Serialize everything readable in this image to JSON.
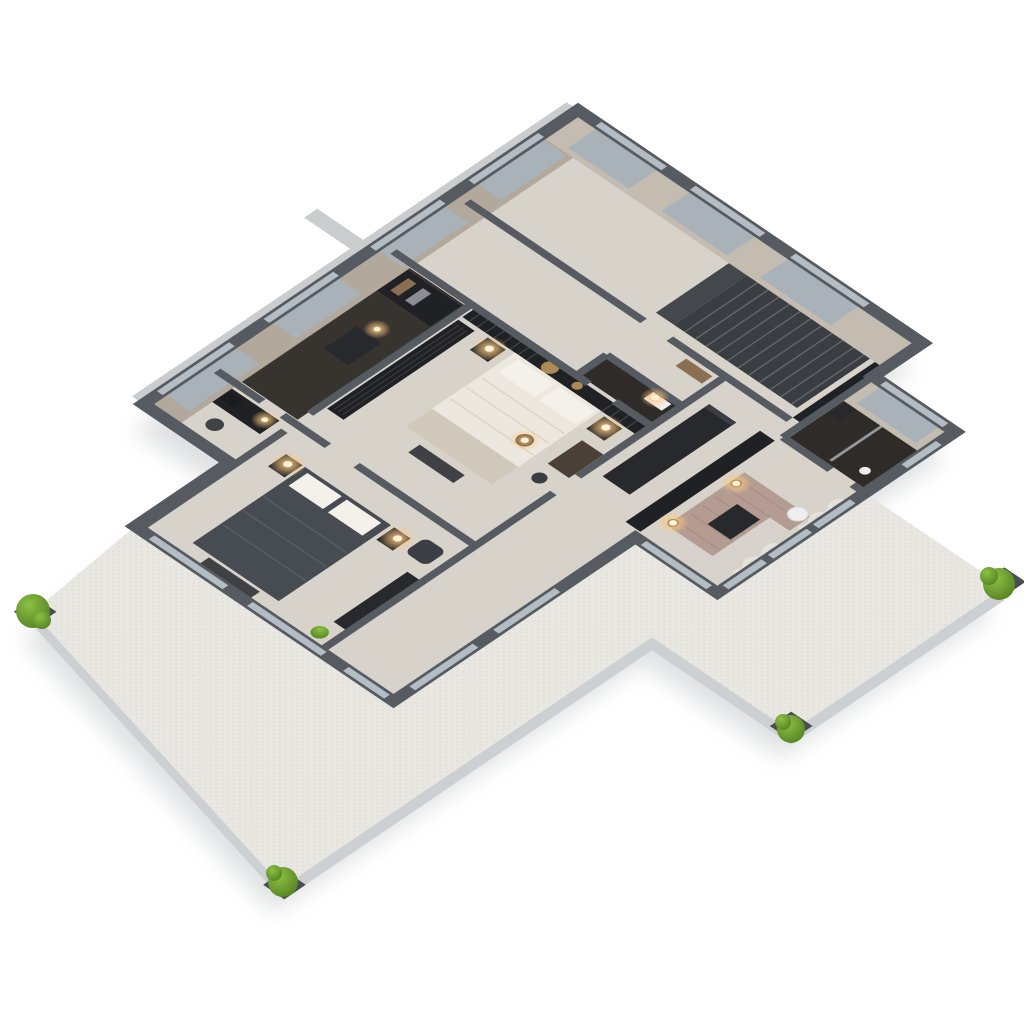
{
  "scene": {
    "kind": "3d-floor-plan-render",
    "title": "Apartment 3D floor plan (axonometric render)",
    "view": "top-down axonometric, plan rotated ~34 degrees, white studio background",
    "building_shape": "L-shaped apartment with wrap-around L-shaped terrace at south and east",
    "text_visible_in_image": "none"
  },
  "colors": {
    "bg": "#ffffff",
    "shadow": "#9a9da1",
    "slab_side": "#cdd0d3",
    "terrace": "#e9e7e1",
    "terrace_speckle": "#dcd9d2",
    "wall": "#565b62",
    "wallface": "#c4bcb1",
    "wallface_w": "#b2a99c",
    "glass": "#b5bdc4",
    "glass_pane": "#a9b2b8",
    "floor": "#d8d3ca",
    "floor_dark": "#37332f",
    "floor_bath": "#2e2b29",
    "furn_dark": "#27292d",
    "furn_darker": "#1f2124",
    "bed_cream": "#ece7df",
    "bed_fold": "#d6cfc2",
    "pillow": "#f4f1ea",
    "sofa": "#d7d3cc",
    "rug": "#b49c92",
    "rug_dark": "#9c8177",
    "duvet_dark": "#474b52",
    "duvet_fold": "#5c6066",
    "bench": "#3f4145",
    "wood": "#8a6f52",
    "gold": "#ad8a55",
    "glow": "#ffc87d",
    "glow_core": "#fff1d8",
    "tree_light": "#8cc044",
    "tree_dark": "#4e7a1e",
    "planter": "#4a4d52",
    "curtain": "#e7e3da",
    "fin": "#caccce",
    "stair": "#3a3d42",
    "stair_light": "#63676d",
    "landing": "#44474c",
    "slat": "#44474d",
    "fixture_white": "#eceeef"
  },
  "rooms": [
    {
      "id": "entry-hall",
      "label": "Entry hall with staircase",
      "furniture": [
        "staircase",
        "potted-plant"
      ]
    },
    {
      "id": "corridor",
      "label": "Central corridor",
      "furniture": [
        "console-table"
      ]
    },
    {
      "id": "bathroom-small",
      "label": "Small bathroom (dark tile)",
      "furniture": [
        "vanity"
      ]
    },
    {
      "id": "bathroom-wing",
      "label": "Wing bathroom (dark tile)",
      "furniture": [
        "shower-glass",
        "wc",
        "vanity"
      ]
    },
    {
      "id": "kitchen",
      "label": "Kitchen",
      "furniture": [
        "island",
        "tall-cabinets"
      ]
    },
    {
      "id": "living-room",
      "label": "Living room",
      "furniture": [
        "media-wall",
        "rug",
        "sofa",
        "coffee-table",
        "floor-lamp",
        "floor-lamp",
        "round-side-table",
        "curtains"
      ]
    },
    {
      "id": "master-bedroom",
      "label": "Master bedroom",
      "furniture": [
        "slatted-headboard-wall",
        "gold-wall-discs",
        "double-bed-cream",
        "nightstand",
        "nightstand",
        "wardrobe-glass",
        "bench",
        "pendant-lamp",
        "desk",
        "chair"
      ]
    },
    {
      "id": "walk-in-closet",
      "label": "Walk-in closet (dark floor)",
      "furniture": [
        "wardrobe-units",
        "dresser"
      ]
    },
    {
      "id": "study",
      "label": "Study / office",
      "furniture": [
        "desk",
        "office-chair",
        "shelving"
      ]
    },
    {
      "id": "bedroom-2",
      "label": "Second bedroom",
      "furniture": [
        "double-bed-dark",
        "nightstand",
        "nightstand",
        "bench",
        "armchair",
        "sideboard",
        "potted-plant"
      ]
    }
  ],
  "terrace": {
    "label": "Wrap-around terrace",
    "corner_shrubs": 4,
    "shrub_positions": [
      "west",
      "south",
      "east",
      "south-east"
    ]
  },
  "lighting": {
    "lit_lamps_count": 10,
    "style": "warm glow spots at nightstands, vanity, living room and desk lamps"
  }
}
